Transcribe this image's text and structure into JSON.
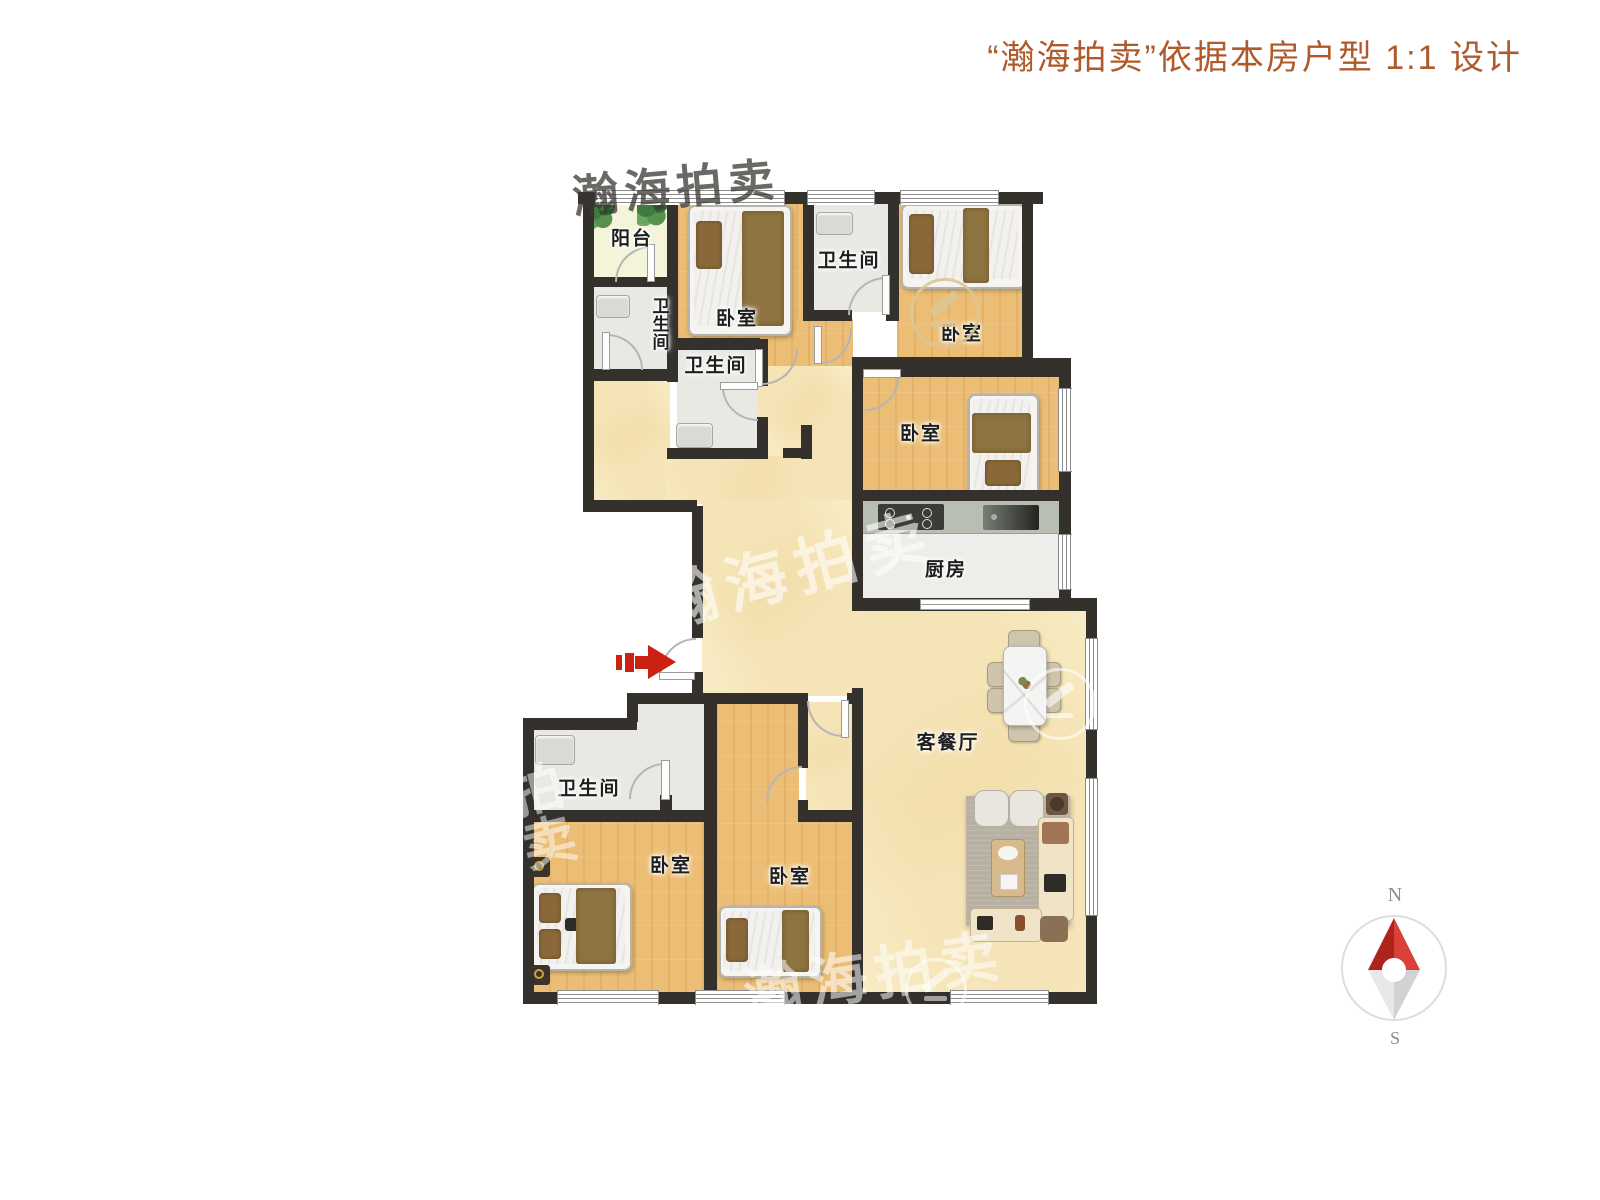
{
  "title": "“瀚海拍卖”依据本房户型 1:1 设计",
  "brand_watermark": "瀚海拍卖",
  "brand_watermark_short": "拍卖",
  "rooms": {
    "balcony": {
      "label": "阳台"
    },
    "bath_top": {
      "label": "卫生间"
    },
    "bath_mid_top": {
      "label": "卫生间"
    },
    "bath_inner": {
      "label": "卫生间"
    },
    "bath_lower": {
      "label": "卫生间"
    },
    "bedroom_top_left": {
      "label": "卧室"
    },
    "bedroom_top_right": {
      "label": "卧室"
    },
    "bedroom_right": {
      "label": "卧室"
    },
    "bedroom_bottom_left": {
      "label": "卧室"
    },
    "bedroom_bottom_mid": {
      "label": "卧室"
    },
    "kitchen": {
      "label": "厨房"
    },
    "living_dining": {
      "label": "客餐厅"
    }
  },
  "compass": {
    "north": "N",
    "south": "S"
  },
  "colors": {
    "title_accent": "#b0592b",
    "entry_arrow_red": "#cc2112",
    "compass_red": "#c4342c",
    "wall": "#34312c",
    "wood_floor": "#ecbe75",
    "hall_floor": "#f8ebc4"
  }
}
